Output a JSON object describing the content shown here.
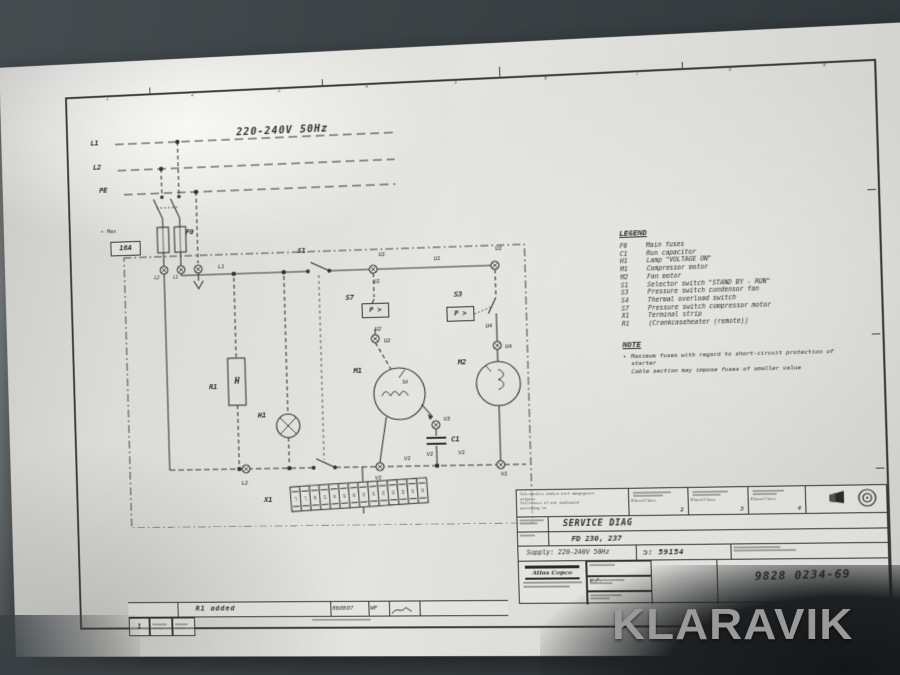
{
  "colors": {
    "wall": "#41484b",
    "paper": "#dcdcd8",
    "ink": "#35332f",
    "watermark_gray": "#9a9a9a"
  },
  "watermark": {
    "text": "KLARAVIK"
  },
  "frame": {
    "columns": [
      "1",
      "2",
      "3",
      "4",
      "5",
      "6",
      "7",
      "8",
      "9"
    ]
  },
  "header": {
    "supply": "220-240V  50Hz"
  },
  "mains": {
    "bullet": "•",
    "max_label": "Max",
    "fuse_rating": "16A"
  },
  "schematic": {
    "pressure_label": "P >",
    "labels": [
      {
        "t": "L1",
        "x": 100,
        "y": 82,
        "cls": "s8"
      },
      {
        "t": "L2",
        "x": 102,
        "y": 107,
        "cls": "s8"
      },
      {
        "t": "PE",
        "x": 108,
        "y": 131,
        "cls": "s8"
      },
      {
        "t": "F0",
        "x": 198,
        "y": 177,
        "cls": "s8"
      },
      {
        "t": "L2",
        "x": 162,
        "y": 224,
        "cls": "s5"
      },
      {
        "t": "L1",
        "x": 182,
        "y": 224,
        "cls": "s5"
      },
      {
        "t": "L1",
        "x": 230,
        "y": 214
      },
      {
        "t": "S1",
        "x": 314,
        "y": 200,
        "cls": "s8"
      },
      {
        "t": "U1",
        "x": 396,
        "y": 207
      },
      {
        "t": "U1",
        "x": 452,
        "y": 213
      },
      {
        "t": "U1",
        "x": 514,
        "y": 205
      },
      {
        "t": "U1",
        "x": 390,
        "y": 234
      },
      {
        "t": "S7",
        "x": 362,
        "y": 249,
        "cls": "s8"
      },
      {
        "t": "U2",
        "x": 390,
        "y": 282
      },
      {
        "t": "U2",
        "x": 399,
        "y": 294
      },
      {
        "t": "S3",
        "x": 472,
        "y": 249,
        "cls": "s8"
      },
      {
        "t": "U4",
        "x": 502,
        "y": 282
      },
      {
        "t": "U4",
        "x": 521,
        "y": 303
      },
      {
        "t": "M1",
        "x": 368,
        "y": 323,
        "cls": "s8"
      },
      {
        "t": "S4",
        "x": 416,
        "y": 337,
        "cls": "s5"
      },
      {
        "t": "M2",
        "x": 474,
        "y": 317,
        "cls": "s8"
      },
      {
        "t": "R1",
        "x": 218,
        "y": 336,
        "cls": "s8"
      },
      {
        "t": "H",
        "x": 243,
        "y": 332,
        "cls": "s9"
      },
      {
        "t": "H1",
        "x": 268,
        "y": 366,
        "cls": "s8"
      },
      {
        "t": "V3",
        "x": 457,
        "y": 374
      },
      {
        "t": "C1",
        "x": 465,
        "y": 394,
        "cls": "s8"
      },
      {
        "t": "V1",
        "x": 439,
        "y": 409
      },
      {
        "t": "V1",
        "x": 386,
        "y": 432
      },
      {
        "t": "L2",
        "x": 248,
        "y": 435
      },
      {
        "t": "V1",
        "x": 416,
        "y": 413
      },
      {
        "t": "V1",
        "x": 471,
        "y": 408
      },
      {
        "t": "V1",
        "x": 513,
        "y": 430
      },
      {
        "t": "X1",
        "x": 272,
        "y": 452,
        "cls": "s8"
      }
    ],
    "x1_terminals": [
      "L2",
      "L1",
      "PE",
      "U1",
      "U1",
      "U2",
      "U2",
      "V1",
      "V1",
      "V3",
      "U1",
      "U4",
      "V1",
      "V3"
    ]
  },
  "legend": {
    "title": "LEGEND",
    "items": [
      {
        "code": "F0",
        "desc": "Main fuses"
      },
      {
        "code": "C1",
        "desc": "Run capacitor"
      },
      {
        "code": "H1",
        "desc": "Lamp \"VOLTAGE ON\""
      },
      {
        "code": "M1",
        "desc": "Compressor motor"
      },
      {
        "code": "M2",
        "desc": "Fan motor"
      },
      {
        "code": "S1",
        "desc": "Selector switch \"STAND BY - RUN\""
      },
      {
        "code": "S3",
        "desc": "Pressure switch condensor fan"
      },
      {
        "code": "S4",
        "desc": "Thermal overload switch"
      },
      {
        "code": "S7",
        "desc": "Pressure switch compressor motor"
      },
      {
        "code": "X1",
        "desc": "Terminal strip"
      },
      {
        "code": "R1",
        "desc": "(Crankcaseheater (remote))"
      }
    ]
  },
  "note": {
    "title": "NOTE",
    "lines": [
      "Maximum fuses with regard to short-circuit protection of starter",
      "Cable section may impose fuses of smaller value"
    ]
  },
  "title_block": {
    "tolerance_lines": [
      "Toleranties indien niet aangegeven",
      "volgens",
      "Tolerances if not indicated",
      "according to"
    ],
    "class_word": "Klass/Class",
    "classes": [
      "2",
      "3",
      "4"
    ],
    "title": "SERVICE DIAG",
    "model": "FD 230, 237",
    "supply": "Supply: 220-240V 50Hz",
    "ref_symbol": "⊃:",
    "ref_number": "59154",
    "drawing_number": "9828 0234-69",
    "company": "Atlas Copco",
    "drawn_initials": "W.F."
  },
  "revision": {
    "number": "1",
    "description": "R1 added",
    "date": "860807",
    "initials": "WF"
  }
}
